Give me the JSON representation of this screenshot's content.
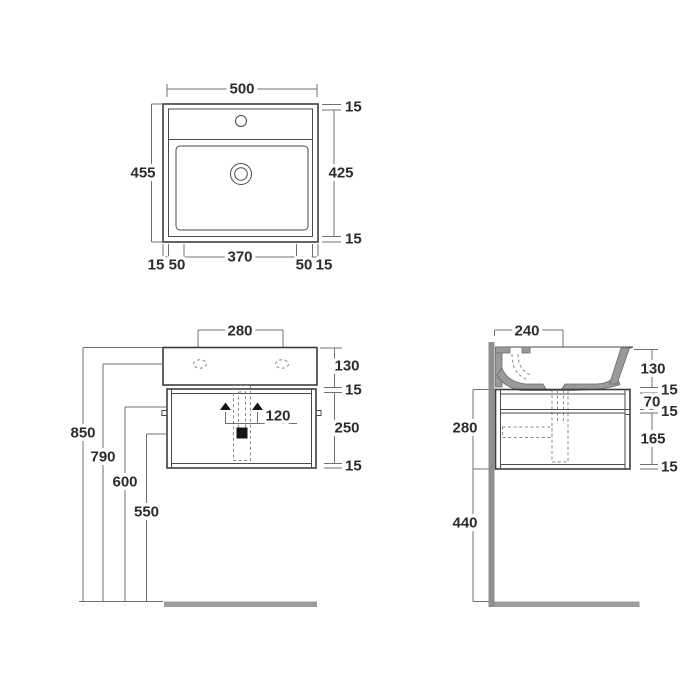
{
  "drawing": {
    "type": "technical-drawing",
    "subject": "wall-hung washbasin with cabinet, three orthographic views",
    "colors": {
      "line": "#3d3d3d",
      "dimension_line": "#707070",
      "ceramic_gray": "#9a9a9a",
      "wall_gray": "#8f8f8f",
      "floor_gray": "#9c9c9c",
      "text": "#2c2c2c"
    },
    "views": {
      "top": {
        "label": "plan view",
        "dims": {
          "overall_width": "500",
          "overall_depth": "455",
          "rim_top": "15",
          "basin_depth": "425",
          "rim_bottom": "15",
          "edge_left": "15",
          "offset_left": "50",
          "basin_width": "370",
          "offset_right": "50",
          "edge_right": "15"
        },
        "icons": [
          "faucet-hole",
          "drain"
        ]
      },
      "front": {
        "label": "front elevation",
        "dims": {
          "hole_spacing": "280",
          "basin_height": "130",
          "gap_top": "15",
          "cabinet_height": "250",
          "cabinet_bottom": "15",
          "bracket_spacing": "120",
          "height_total": "850",
          "height_rim": "790",
          "height_bracket": "600",
          "height_trap": "550"
        },
        "icons": [
          "fixing-hole-left",
          "fixing-hole-right",
          "bracket-left",
          "bracket-right",
          "drain-outlet"
        ]
      },
      "side": {
        "label": "side section",
        "dims": {
          "depth": "240",
          "basin_height": "130",
          "gap_top": "15",
          "drawer_top": "70",
          "divider": "15",
          "drawer_bottom": "165",
          "panel_bottom": "15",
          "cabinet_height": "280",
          "floor_clearance": "440"
        },
        "icons": [
          "wall",
          "floor",
          "siphon-trap"
        ]
      }
    }
  }
}
